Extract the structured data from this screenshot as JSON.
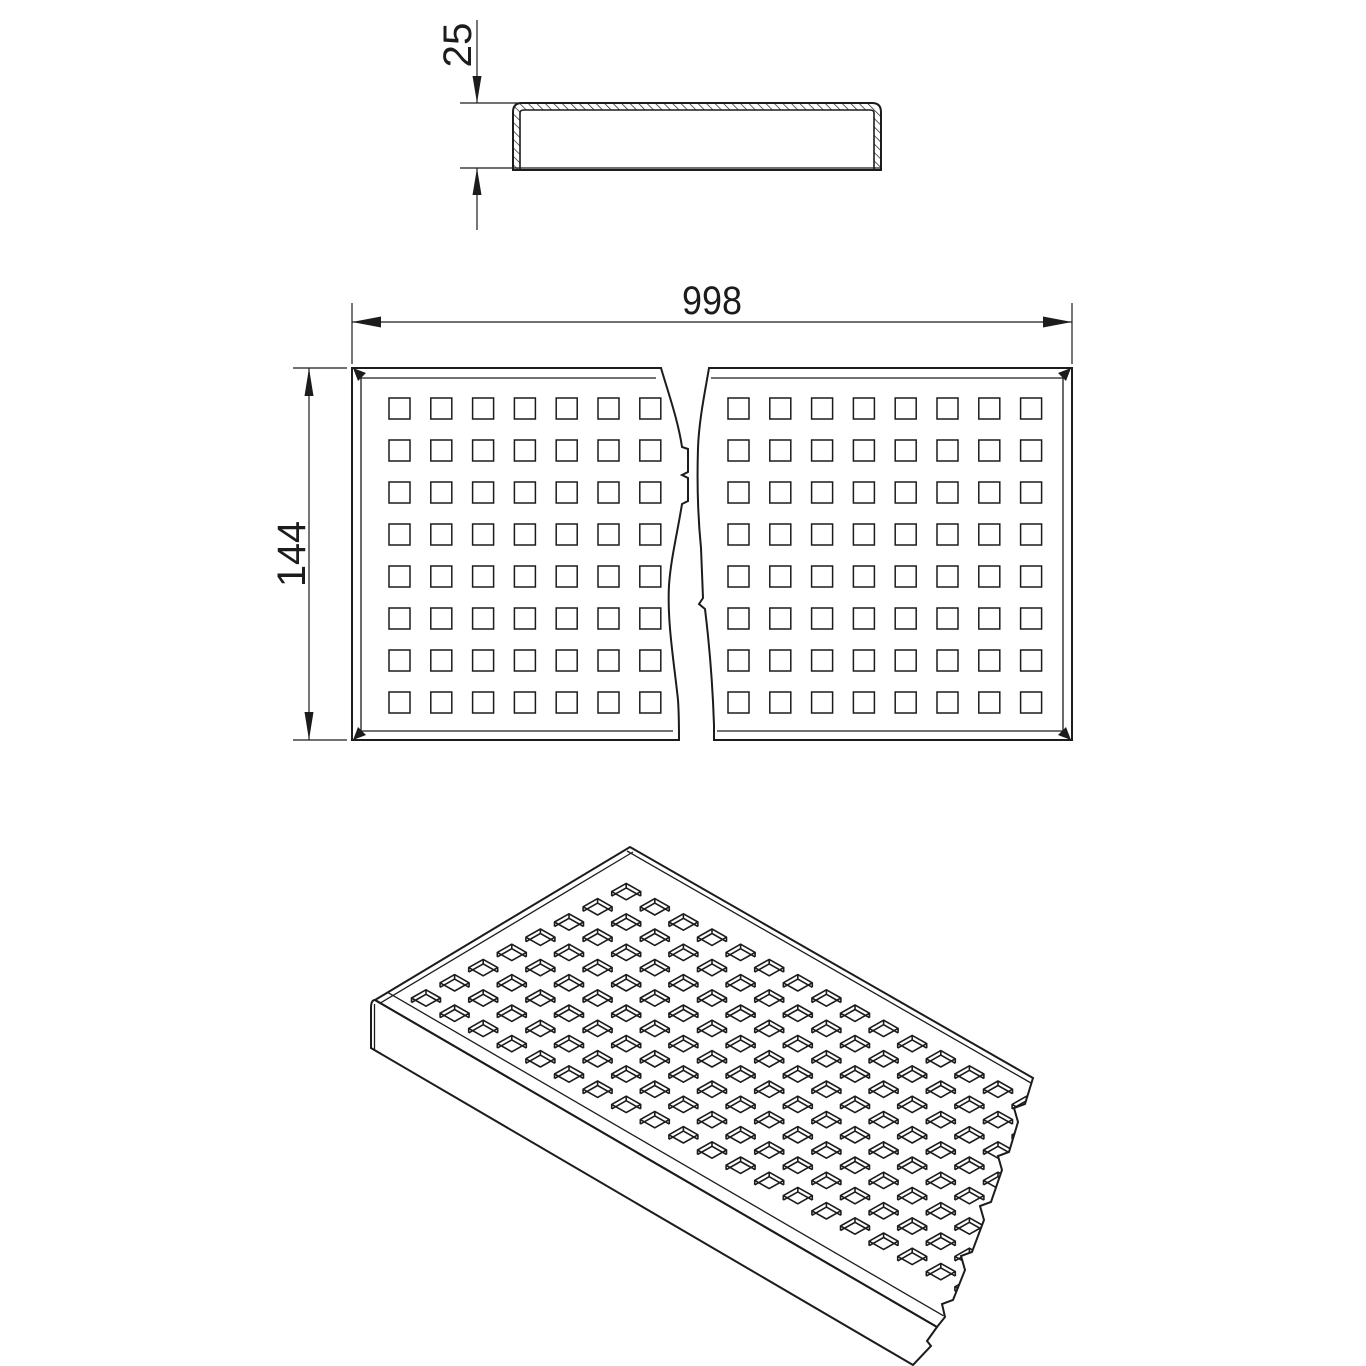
{
  "page": {
    "background": "#ffffff"
  },
  "drawing": {
    "type": "technical-drawing-perforated-grating",
    "line_color": "#1c1c1c",
    "dimensions": {
      "height_label": "25",
      "length_label": "998",
      "width_label": "144"
    },
    "plan": {
      "left_panel": {
        "columns": 7,
        "rows": 8,
        "x0": 389,
        "y0": 398,
        "pitch_x": 41.8,
        "pitch_y": 42,
        "hole_size": 21
      },
      "right_panel": {
        "columns": 8,
        "rows": 8,
        "x0": 728,
        "y0": 398,
        "pitch_x": 41.8,
        "pitch_y": 42,
        "hole_size": 21
      }
    },
    "isometric": {
      "corners": {
        "w": [
          375,
          1000
        ],
        "n": [
          630,
          847
        ],
        "e": [
          1033,
          1078
        ],
        "s": [
          937,
          1327
        ]
      },
      "holes": {
        "origin": [
          426,
          998
        ],
        "u": [
          28.6,
          15.2
        ],
        "v": [
          28.6,
          -15.2
        ],
        "cols": 22,
        "rows": 8,
        "half_w": 14.5,
        "half_h": 8.2,
        "depth": 4.5,
        "edge_margin": 18
      }
    }
  }
}
